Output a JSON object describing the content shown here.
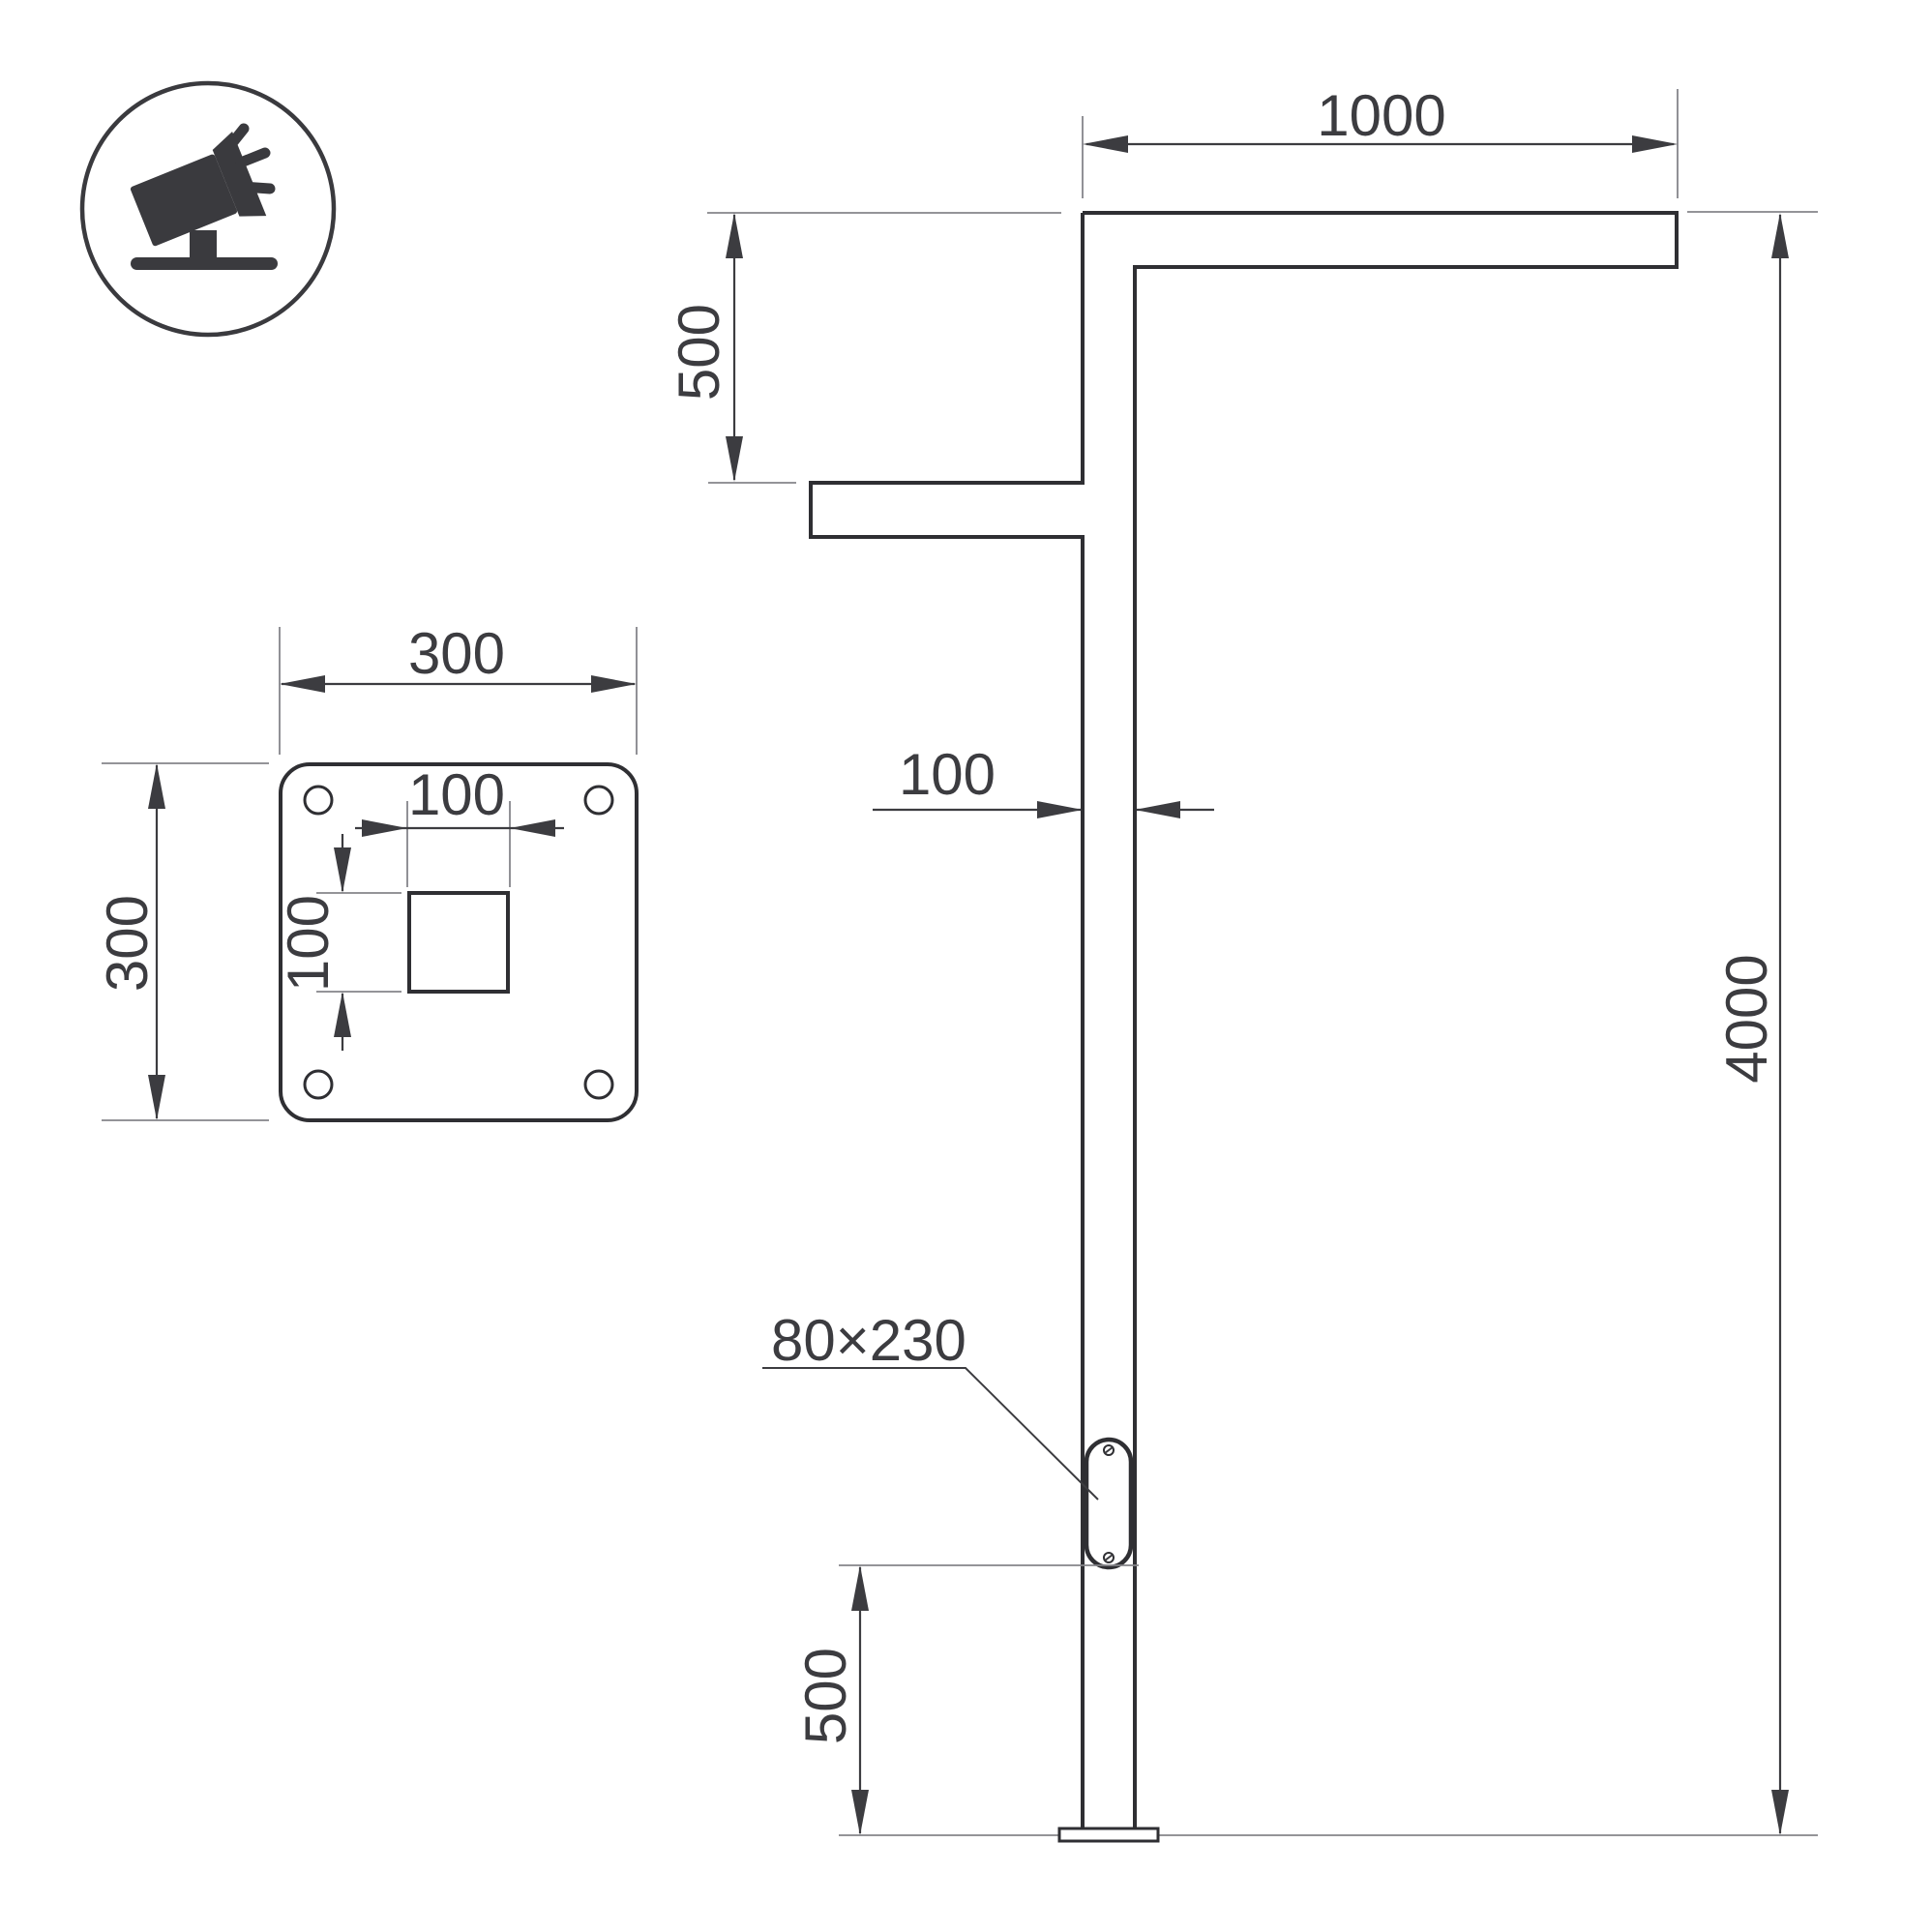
{
  "drawing": {
    "type": "street-light-pole-technical-drawing",
    "colors": {
      "outline": "#2f2f33",
      "dimension": "#3c3c40",
      "extension": "#85858a",
      "background": "#ffffff"
    },
    "icon": {
      "name": "floodlight-icon"
    },
    "elevation": {
      "arm_length": "1000",
      "arm_drop": "500",
      "pole_width": "100",
      "pole_height": "4000",
      "door_size": "80×230",
      "door_height": "500"
    },
    "base_plate": {
      "plate_width": "300",
      "plate_height": "300",
      "hole_width": "100",
      "hole_height": "100"
    }
  }
}
